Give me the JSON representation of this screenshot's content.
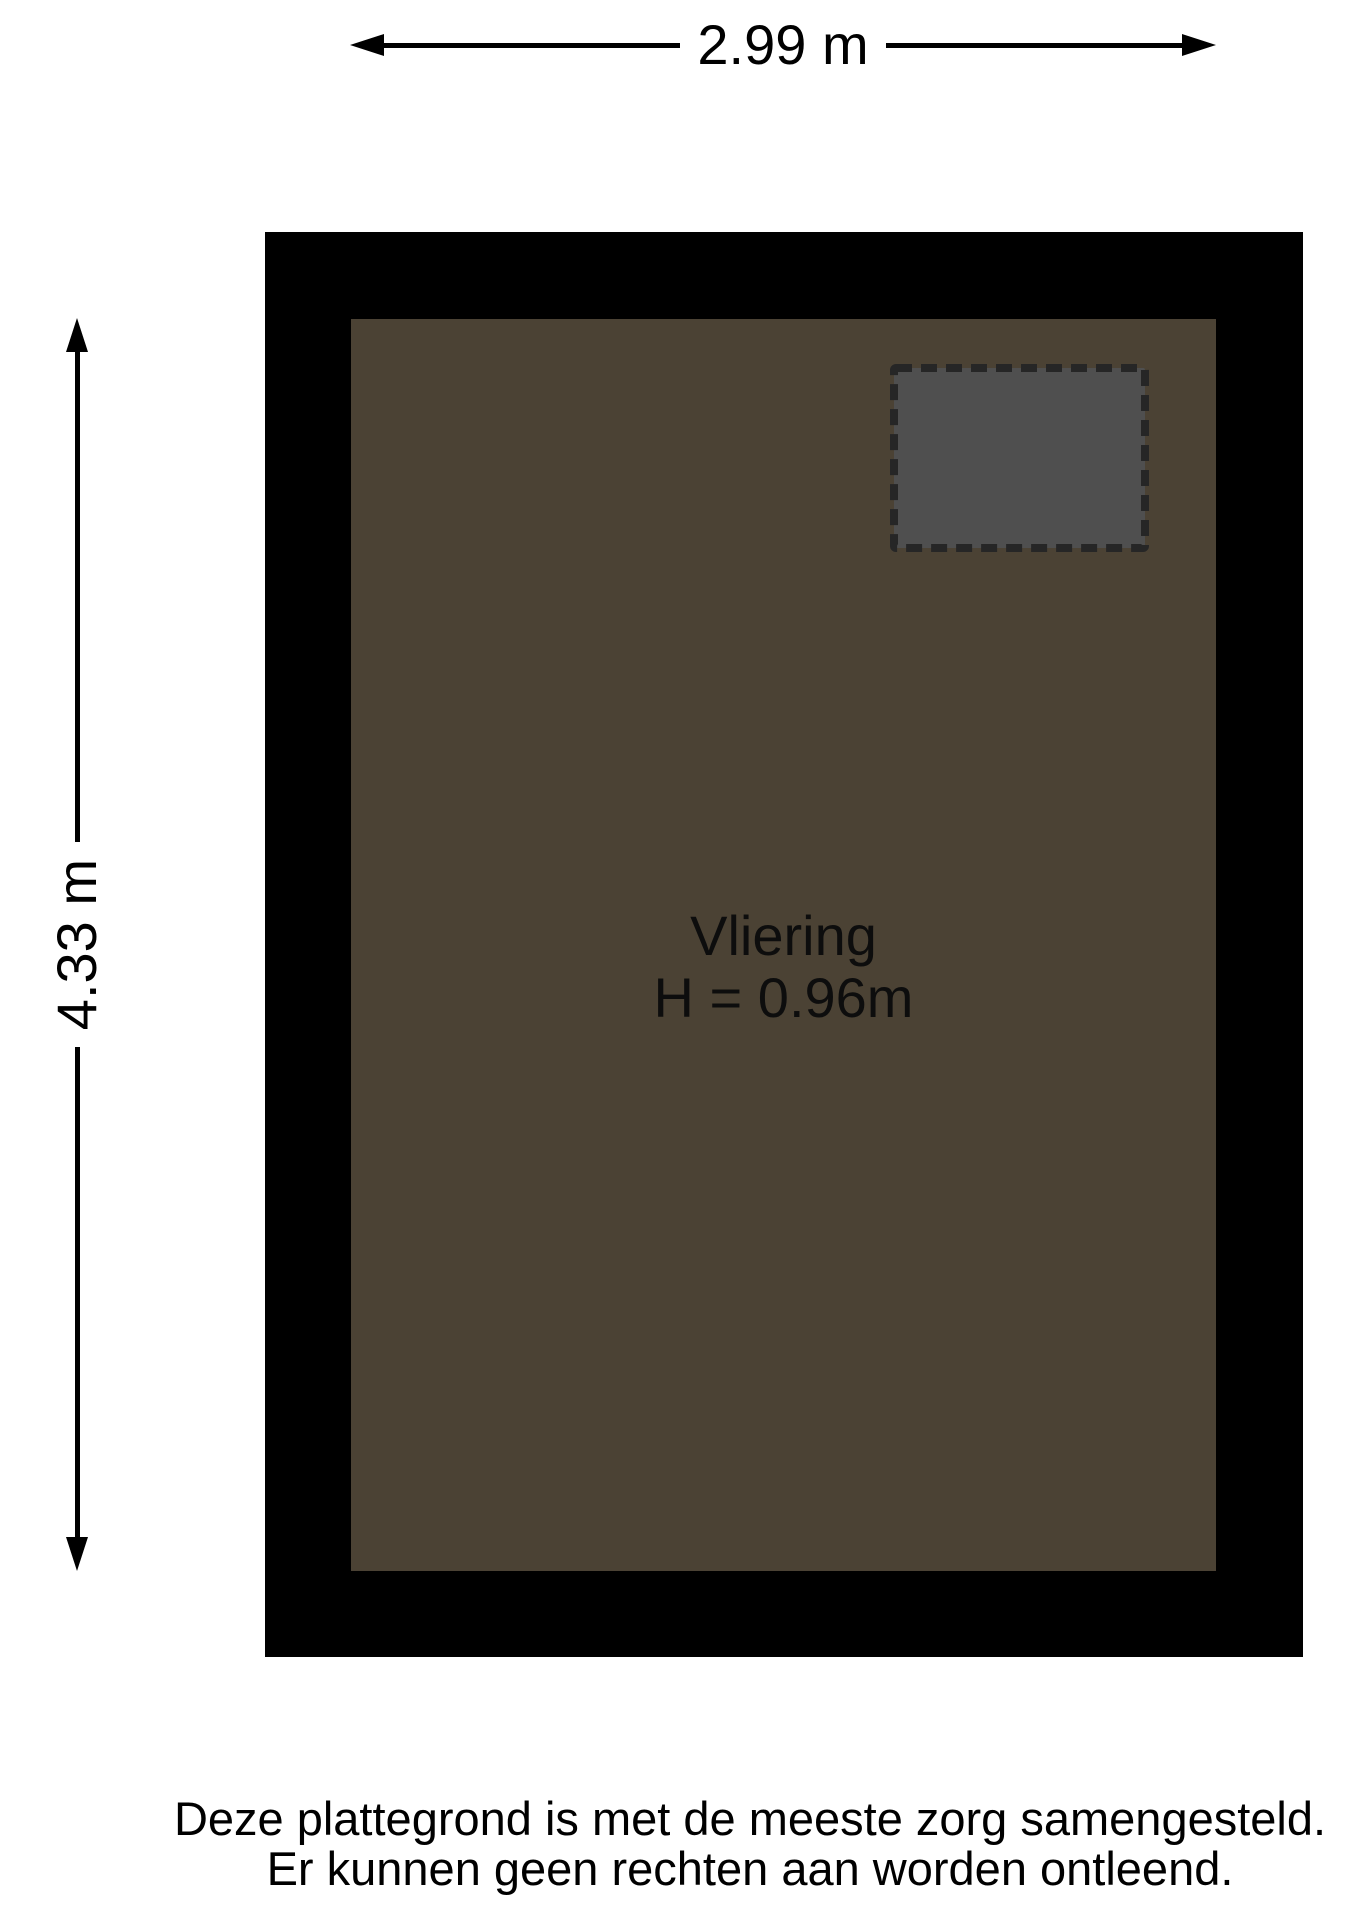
{
  "dimensions": {
    "width_label": "2.99 m",
    "height_label": "4.33 m"
  },
  "room": {
    "name": "Vliering",
    "height_label": "H = 0.96m"
  },
  "footer": {
    "line1": "Deze plattegrond is met de meeste zorg samengesteld.",
    "line2": "Er kunnen geen rechten aan worden ontleend."
  },
  "colors": {
    "wall": "#000000",
    "floor": "#4b4234",
    "hatch_fill": "#4f4f4f",
    "hatch_dash": "#262626"
  }
}
